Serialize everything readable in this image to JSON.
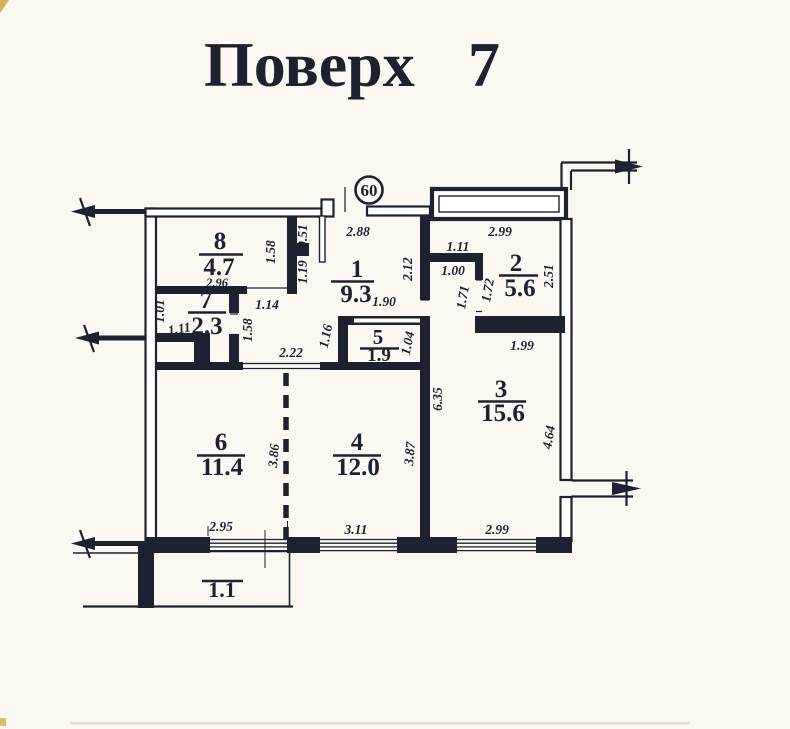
{
  "header": {
    "label": "Поверх",
    "number": "7"
  },
  "plan": {
    "apartment_badge": "60",
    "rooms": {
      "r1": {
        "num": "1",
        "area": "9.3"
      },
      "r2": {
        "num": "2",
        "area": "5.6"
      },
      "r3": {
        "num": "3",
        "area": "15.6"
      },
      "r4": {
        "num": "4",
        "area": "12.0"
      },
      "r5": {
        "num": "5",
        "area": "1.9"
      },
      "r6": {
        "num": "6",
        "area": "11.4"
      },
      "r7": {
        "num": "7",
        "area": "2.3"
      },
      "r8": {
        "num": "8",
        "area": "4.7"
      },
      "balcony": {
        "area": "1.1"
      }
    },
    "dims": {
      "entry_width": "2.88",
      "room8_width": "2.96",
      "room8_right": "1.58",
      "vestibule_upper": "0.51",
      "vestibule_lower": "1.19",
      "room7_door": "1.14",
      "room7_left_a": "1.01",
      "room7_left_b": "1.11",
      "room7_right": "1.58",
      "hall_opening": "2.22",
      "hall_width": "1.90",
      "room5_left": "1.16",
      "room5_right": "1.04",
      "hall_right": "2.12",
      "corridor_top": "1.11",
      "corridor_door": "1.00",
      "corridor_left": "1.71",
      "room2_door": "1.72",
      "room2_top": "2.99",
      "room2_right": "2.51",
      "room3_top": "1.99",
      "room3_left": "6.35",
      "room3_right": "4.64",
      "room4_right": "3.87",
      "partition": "3.86",
      "window_left": "2.95",
      "window_mid": "3.11",
      "window_right": "2.99"
    }
  }
}
